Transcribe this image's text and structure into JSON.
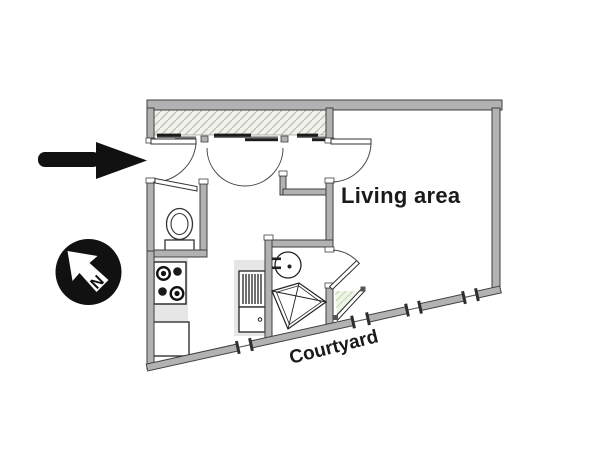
{
  "floor_plan": {
    "labels": {
      "living_area": "Living area",
      "courtyard": "Courtyard",
      "compass_north": "N"
    },
    "colors": {
      "background": "#ffffff",
      "wall_fill": "#b2b2b2",
      "wall_outline": "#3f3f3f",
      "ink": "#111111",
      "counter_gray": "#e6e6e6",
      "closet_hatch_bg": "#f2f2ed",
      "closet_hatch_line": "#bdbdb4",
      "corner_closet_hatch_bg": "#eef4e6",
      "corner_closet_hatch_line": "#c2d6b4"
    },
    "icons": [
      "entrance-arrow-icon",
      "compass-north-icon",
      "closet-sliding-doors-icon",
      "entry-door-swing-icon",
      "double-door-swing-icon",
      "living-room-door-swing-icon",
      "wc-door-icon",
      "bathroom-door-swing-icon",
      "toilet-icon",
      "stove-icon",
      "refrigerator-icon",
      "radiator-icon",
      "washer-icon",
      "bathroom-sink-icon",
      "shower-icon",
      "window-icon",
      "corner-closet-hatch"
    ]
  }
}
